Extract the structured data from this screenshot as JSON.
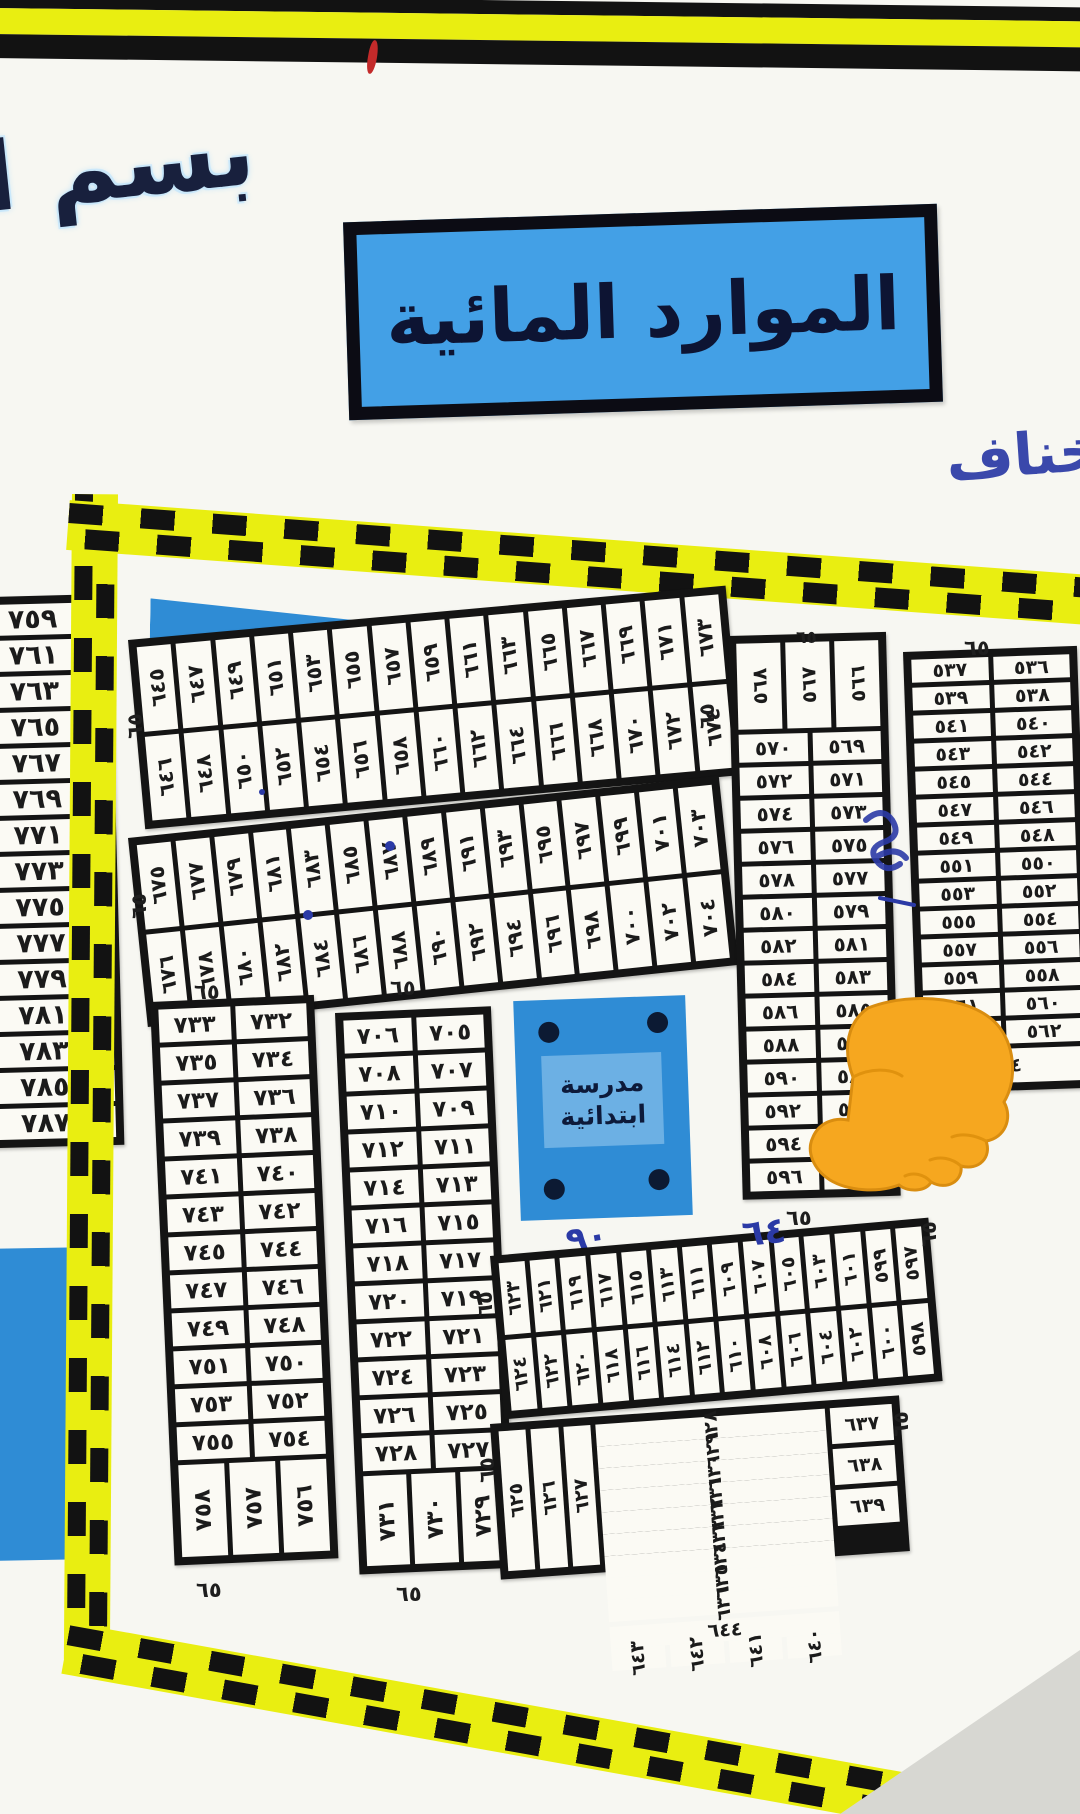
{
  "banner": {
    "bismillah": "بسم ا",
    "title": "الموارد المائية"
  },
  "handwriting": {
    "top_right": "تخناف",
    "below_school": "٩٠",
    "near_bottom_strip": "٦٤"
  },
  "school": {
    "line1": "مدرسة",
    "line2": "ابتدائية"
  },
  "street_label": "٦٥",
  "numerals": "arabic-indic ٠١٢٣٤٥٦٧٨٩",
  "colors": {
    "tape_yellow": "#e9ee11",
    "tape_black": "#121212",
    "map_blue": "#2f8cd5",
    "title_box_blue": "#43a0e6",
    "title_text": "#0d1433",
    "ink_blue": "#2b3aa6",
    "hand_orange": "#f6a71f",
    "red_mark": "#c32a2a"
  },
  "plots": {
    "left_sheet_column": [
      759,
      761,
      763,
      765,
      767,
      769,
      771,
      773,
      775,
      777,
      779,
      781,
      783,
      785,
      787
    ],
    "strip_645": {
      "row_top": [
        645,
        647,
        649,
        651,
        653,
        655,
        657,
        659,
        661,
        663,
        665,
        667,
        669,
        671,
        673
      ],
      "row_bottom": [
        646,
        648,
        650,
        652,
        654,
        656,
        658,
        660,
        662,
        664,
        666,
        668,
        670,
        672,
        674
      ]
    },
    "strip_675": {
      "row_top": [
        675,
        677,
        679,
        681,
        683,
        685,
        687,
        689,
        691,
        693,
        695,
        697,
        699,
        701,
        703
      ],
      "row_bottom": [
        676,
        678,
        680,
        682,
        684,
        686,
        688,
        690,
        692,
        694,
        696,
        698,
        700,
        702,
        704
      ]
    },
    "block_732": {
      "col_left": [
        733,
        735,
        737,
        739,
        741,
        743,
        745,
        747,
        749,
        751,
        753,
        755
      ],
      "col_right": [
        732,
        734,
        736,
        738,
        740,
        742,
        744,
        746,
        748,
        750,
        752,
        754
      ],
      "row_bottom": [
        758,
        757,
        756
      ]
    },
    "block_705": {
      "col_left": [
        706,
        708,
        710,
        712,
        714,
        716,
        718,
        720,
        722,
        724,
        726,
        728
      ],
      "col_right": [
        705,
        707,
        709,
        711,
        713,
        715,
        717,
        719,
        721,
        723,
        725,
        727
      ],
      "row_bottom": [
        731,
        730,
        729
      ]
    },
    "block_566": {
      "row_top": [
        568,
        567,
        566
      ],
      "col_left": [
        570,
        572,
        574,
        576,
        578,
        580,
        582,
        584,
        586,
        588,
        590,
        592,
        594,
        596
      ],
      "col_right": [
        569,
        571,
        573,
        575,
        577,
        579,
        581,
        583,
        585,
        587,
        589,
        591,
        593,
        595
      ]
    },
    "block_536": {
      "col_left": [
        537,
        539,
        541,
        543,
        545,
        547,
        549,
        551,
        553,
        555,
        557,
        559,
        561,
        563
      ],
      "col_right": [
        536,
        538,
        540,
        542,
        544,
        546,
        548,
        550,
        552,
        554,
        556,
        558,
        560,
        562
      ],
      "cell_bottom": 564
    },
    "strip_597": {
      "row_top": [
        623,
        621,
        619,
        617,
        615,
        613,
        611,
        609,
        607,
        605,
        603,
        601,
        599,
        597
      ],
      "row_bottom": [
        624,
        622,
        620,
        618,
        616,
        614,
        612,
        610,
        608,
        606,
        604,
        602,
        600,
        598
      ]
    },
    "strip_625": {
      "tall_left": [
        625,
        626,
        627
      ],
      "row_top": [
        628,
        629,
        630,
        631,
        632,
        633,
        634,
        635,
        636
      ],
      "stack_right": [
        637,
        638,
        639
      ],
      "cell_wide": 644,
      "row_bottom": [
        643,
        642,
        641,
        640
      ]
    }
  }
}
